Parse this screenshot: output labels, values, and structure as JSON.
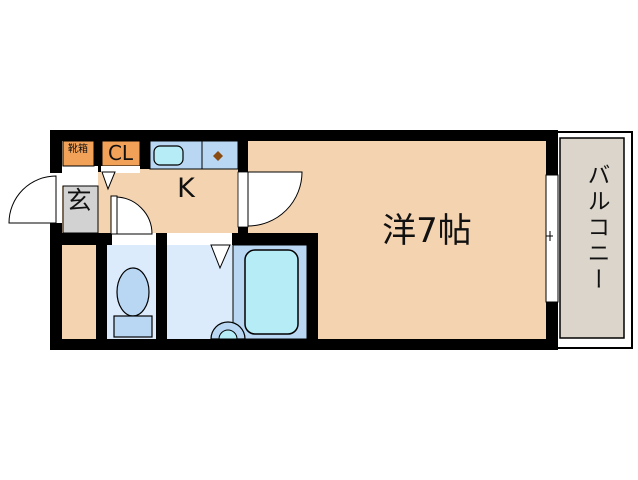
{
  "plan": {
    "rooms": {
      "western_room": "洋7帖",
      "kitchen": "K",
      "entrance": "玄",
      "closet": "CL",
      "shoe_box": "靴箱",
      "balcony": "バルコニー"
    },
    "colors": {
      "wall": "#000000",
      "room_floor": "#f4d3b0",
      "entrance_floor": "#d2d2d2",
      "storage_orange": "#f2a159",
      "wet_room_floor": "#dcebfb",
      "fixture_blue": "#b9d7f3",
      "water_cyan": "#b6ecf6",
      "balcony_floor": "#dbd5cb",
      "burner_brown": "#8a4a10",
      "door_white": "#ffffff"
    }
  }
}
